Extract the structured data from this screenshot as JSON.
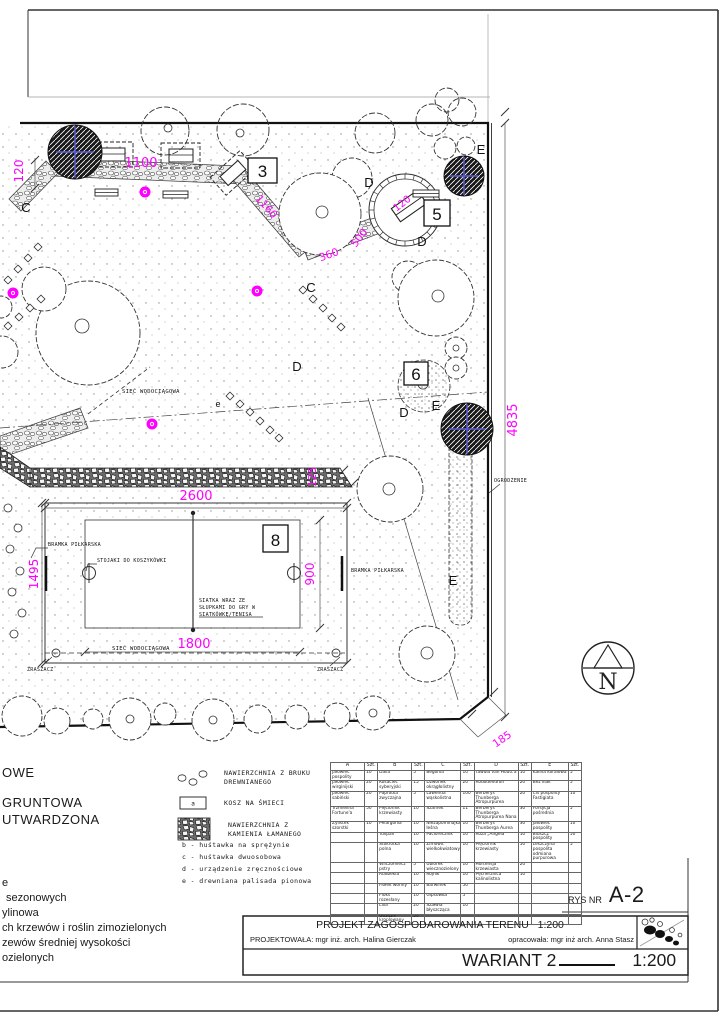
{
  "colors": {
    "dimension_magenta": "#ff00ff",
    "tree_cross_blue": "#5b5bd6",
    "line": "#1a1a1a"
  },
  "plan": {
    "numbers": {
      "n3": "3",
      "n5": "5",
      "n6": "6",
      "n8": "8"
    },
    "letters": {
      "c": "C",
      "d": "D",
      "e_big": "E",
      "e_small": "e"
    },
    "dims": {
      "h120": "120",
      "w1100": "1100",
      "p1160": "1160",
      "p360": "360",
      "p500": "500",
      "plaza120": "120",
      "r4835": "4835",
      "f2600": "2600",
      "f1495": "1495",
      "f900": "900",
      "f1800": "1800",
      "g125": "125",
      "c185": "185"
    },
    "labels": {
      "siec": "SIEĆ WODOCIĄGOWA",
      "ogrodzenie": "OGRODZENIE",
      "bramka": "BRAMKA PIŁKARSKA",
      "stojaki": "STOJAKI DO KOSZYKÓWKI",
      "siatka_l1": "SIATKA WRAZ ZE",
      "siatka_l2": "SŁUPKAMI DO GRY W",
      "siatka_l3": "SIATKÓWKĘ/TENISA",
      "zraszacz": "ZRASZACZ",
      "north": "N"
    }
  },
  "legend": {
    "cut_labels_top": [
      "OWE",
      "GRUNTOWA",
      "UTWARDZONA"
    ],
    "surface_wood_l1": "NAWIERZCHNIA Z BRUKU",
    "surface_wood_l2": "DREWNIANEGO",
    "trash": "KOSZ NA ŚMIECI",
    "trash_symbol": "a",
    "surface_stone_l1": "NAWIERZCHNIA Z",
    "surface_stone_l2": "KAMIENIA ŁAMANEGO",
    "items": [
      "b - huśtawka na sprężynie",
      "c - huśtawka dwuosobowa",
      "d - urządzenie zręcznościowe",
      "e - drewniana palisada pionowa"
    ],
    "cut_lines_bottom": [
      "e",
      "sezonowych",
      "ylinowa",
      "ch krzewów i roślin zimozielonych",
      "zewów średniej wysokości",
      "ozielonych"
    ]
  },
  "plant_table": {
    "headers": [
      "A",
      "Szt.",
      "B",
      "Szt.",
      "C",
      "Szt.",
      "D",
      "Szt.",
      "E",
      "Szt."
    ],
    "rows": [
      [
        "Jałowiec pospolity",
        "10",
        "Dalia",
        "5",
        "Begonia",
        "10",
        "Tawuła van Houtt'a",
        "10",
        "Kalina koralowa",
        "5"
      ],
      [
        "Jałowiec wirginijski",
        "20",
        "Kosaciec syberyjski",
        "15",
        "Dzwonek okrągłolistny",
        "20",
        "Rododendron",
        "20",
        "Bez lilak",
        "5"
      ],
      [
        "Jałowiec sabiński",
        "20",
        "Paprotka zwyczajna",
        "5",
        "Lawenda wąskolistna",
        "100",
        "Berberys Thunberga Atropurpurea",
        "20",
        "Cis pospolity Fastigiata",
        "10"
      ],
      [
        "Trzmielina Fortune'a",
        "50",
        "Pięciornik krzewiasty",
        "10",
        "Szafirek",
        "11",
        "Berberys Thunberga Atropurpurea Nana",
        "30",
        "Forsycja pośrednia",
        "5"
      ],
      [
        "Żylistek szorstki",
        "10",
        "Pelargonia",
        "10",
        "Niezapominajka leśna",
        "10",
        "Berberys Thunberga Aurea",
        "30",
        "Jałowiec pospolity",
        "10"
      ],
      [
        "",
        "",
        "Tulipan",
        "10",
        "Paciorecznik",
        "10",
        "Róża „Angela”",
        "10",
        "Bluszcz pospolity",
        "50"
      ],
      [
        "",
        "",
        "Stokrotka polna",
        "10",
        "Zimowit wielkokwiatowy",
        "10",
        "Pięciornik krzewiasty",
        "50",
        "Leszczyna pospolita odmiana purpurowa",
        "5"
      ],
      [
        "",
        "",
        "Wilczomlecz pstry",
        "5",
        "Ubiorek wiecznozielony",
        "10",
        "Hortensja krzewiasta",
        "20",
        "",
        ""
      ],
      [
        "",
        "",
        "Rudbekia",
        "10",
        "Rojnik",
        "10",
        "Pęcherznica kalinolistna",
        "10",
        "",
        ""
      ],
      [
        "",
        "",
        "Fiołek wonny",
        "10",
        "Barwinek",
        "50",
        "",
        "",
        "",
        ""
      ],
      [
        "",
        "",
        "Floks rozesłany",
        "10",
        "Gipsówka",
        "5",
        "",
        "",
        "",
        ""
      ],
      [
        "",
        "",
        "Lilia",
        "20",
        "Szałwia błyszcząca",
        "10",
        "",
        "",
        "",
        ""
      ],
      [
        "",
        "",
        "Goździk kroplowany",
        "50",
        "",
        "",
        "",
        "",
        "",
        ""
      ]
    ]
  },
  "title_block": {
    "rys_nr_label": "RYS NR",
    "rys_nr": "A-2",
    "project_title": "PROJEKT ZAGOSPODAROWANIA TERENU",
    "project_scale": "1:200",
    "designed_by": "PROJEKTOWAŁA: mgr inż. arch. Halina Gierczak",
    "prepared_by": "opracowała: mgr inż arch. Anna Stasz",
    "variant": "WARIANT 2",
    "variant_scale": "1:200"
  }
}
